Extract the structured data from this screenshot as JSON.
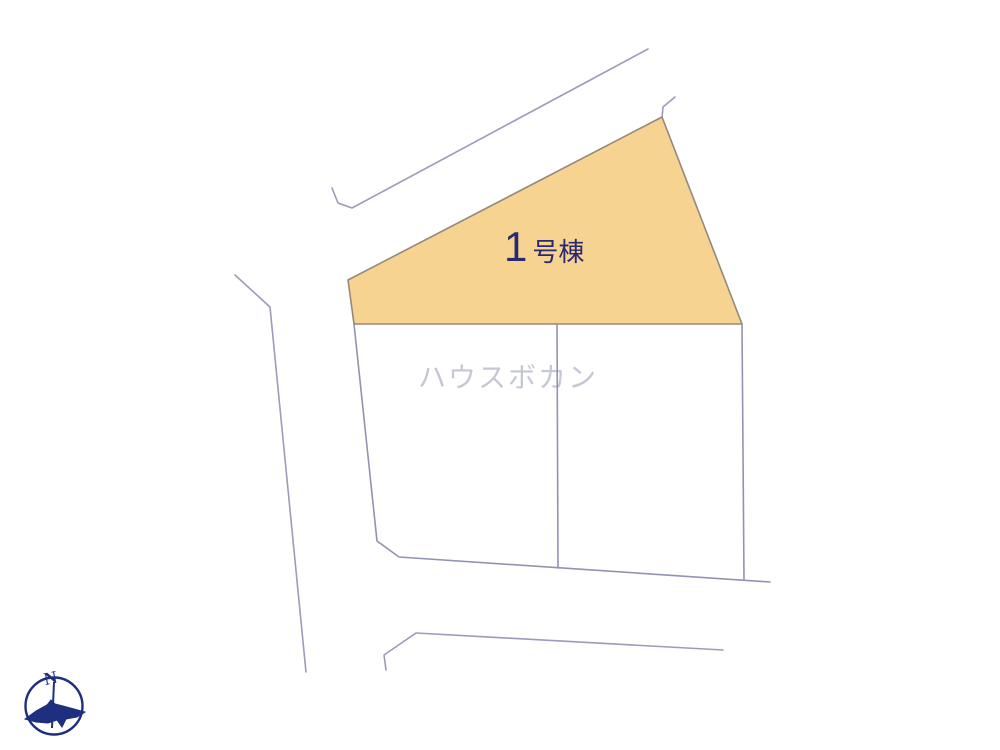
{
  "plan": {
    "lot_label": {
      "number": "1",
      "suffix": "号棟"
    },
    "watermark": "ハウスボカン",
    "compass_letter": "N",
    "unlabeled_lot_count": 2,
    "lots": [
      {
        "name": "lot-1",
        "label": "1号棟",
        "highlighted": true
      }
    ],
    "colors": {
      "lot_fill": "#f7d391",
      "lot_border": "#94897c",
      "road_line": "#9a9cba",
      "parcel_line": "#9193b2",
      "label_text": "#28296e",
      "compass_navy": "#1d2f7e",
      "watermark_text": "#c5c7d4",
      "background": "#ffffff"
    }
  }
}
